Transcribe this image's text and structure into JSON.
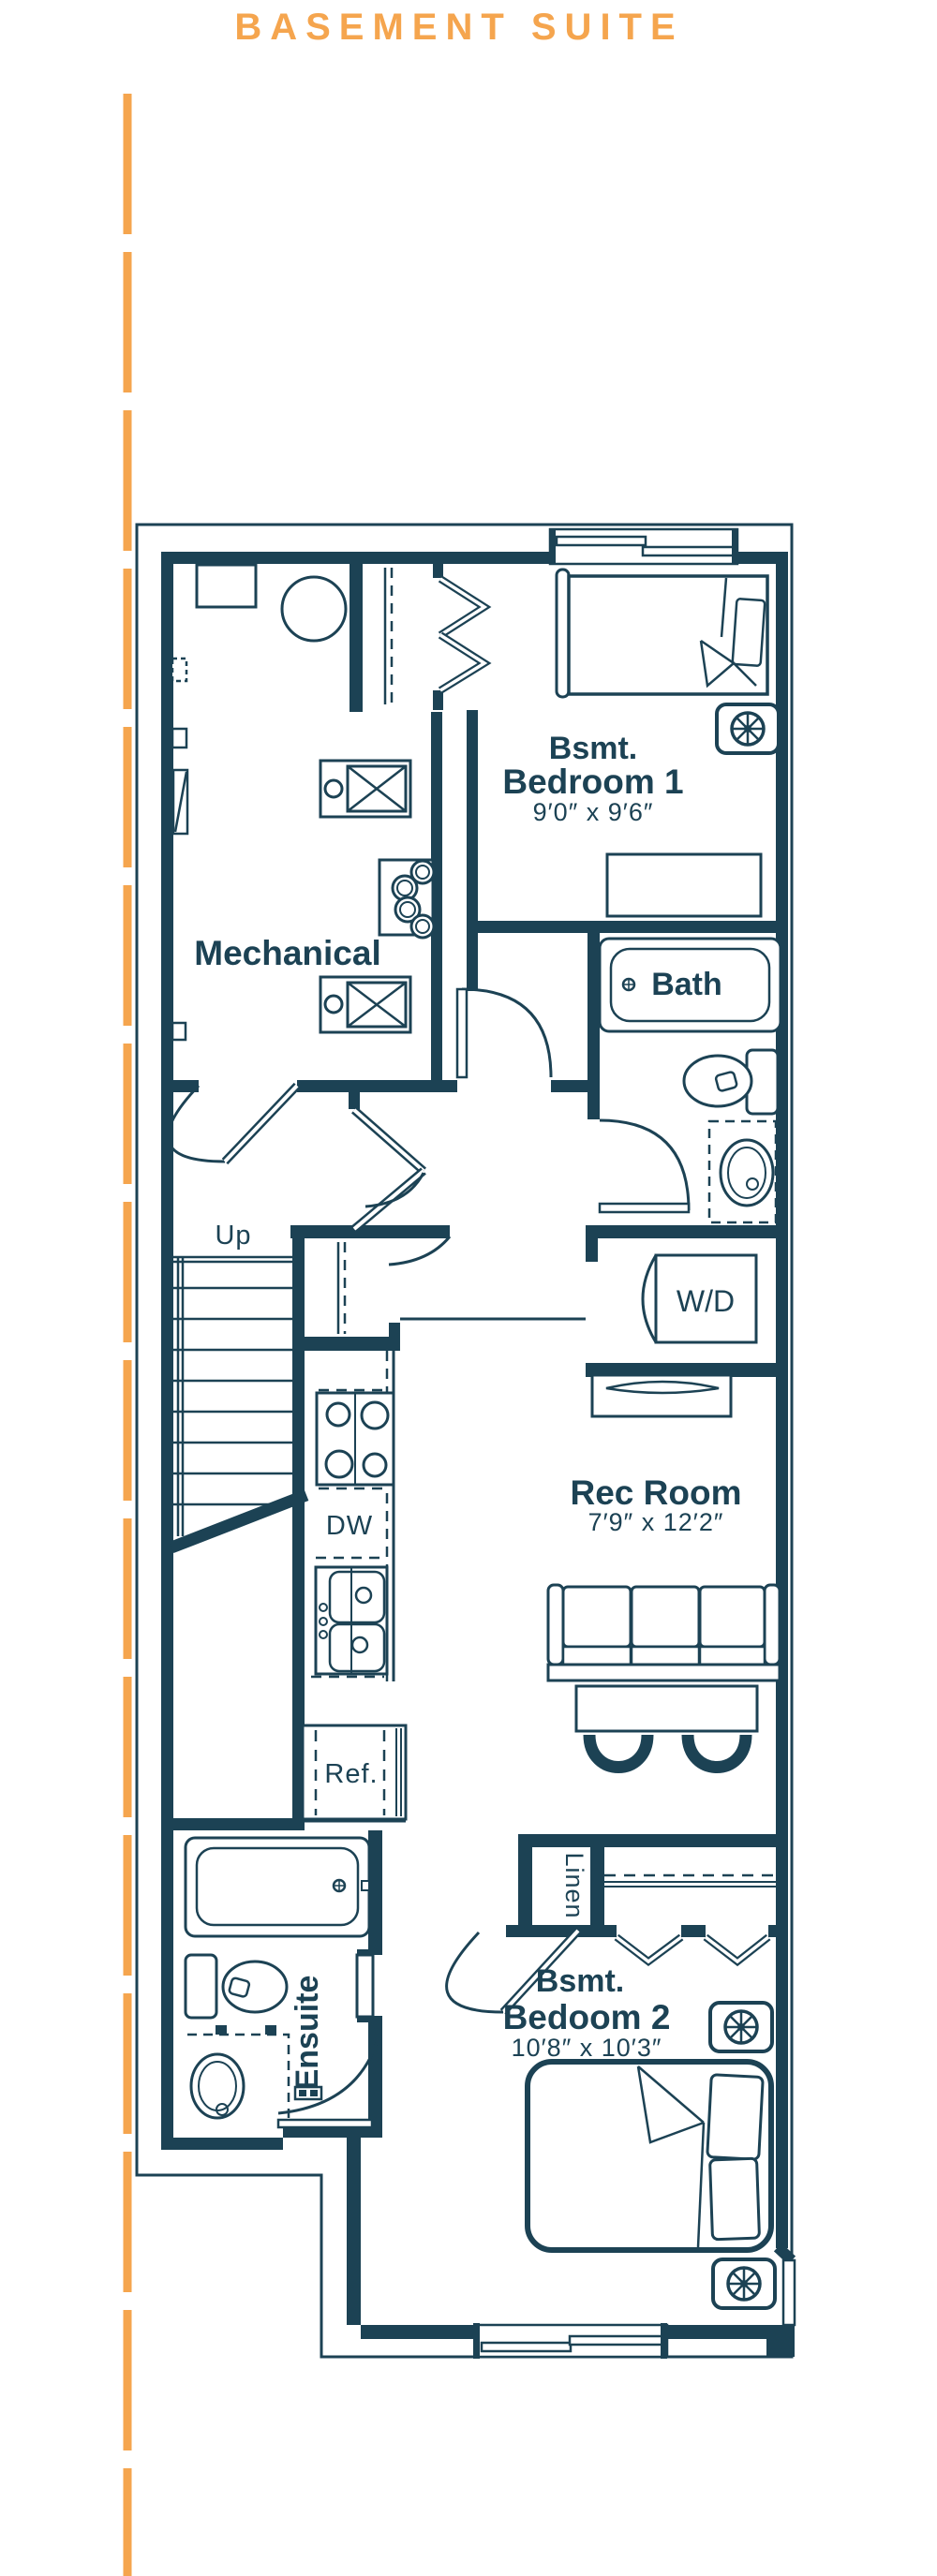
{
  "title": "BASEMENT SUITE",
  "colors": {
    "ink": "#1c4254",
    "accent": "#f5a54e"
  },
  "rooms": {
    "bedroom1": {
      "line1": "Bsmt.",
      "line2": "Bedroom 1",
      "dims": "9′0″ x 9′6″"
    },
    "mechanical": {
      "label": "Mechanical"
    },
    "bath": {
      "label": "Bath"
    },
    "up": {
      "label": "Up"
    },
    "wd": {
      "label": "W/D"
    },
    "rec": {
      "label": "Rec Room",
      "dims": "7′9″ x 12′2″"
    },
    "dw": {
      "label": "DW"
    },
    "ref": {
      "label": "Ref."
    },
    "linen": {
      "label": "Linen"
    },
    "ensuite": {
      "label": "Ensuite"
    },
    "bedroom2": {
      "line1": "Bsmt.",
      "line2": "Bedoom 2",
      "dims": "10′8″ x 10′3″"
    }
  }
}
